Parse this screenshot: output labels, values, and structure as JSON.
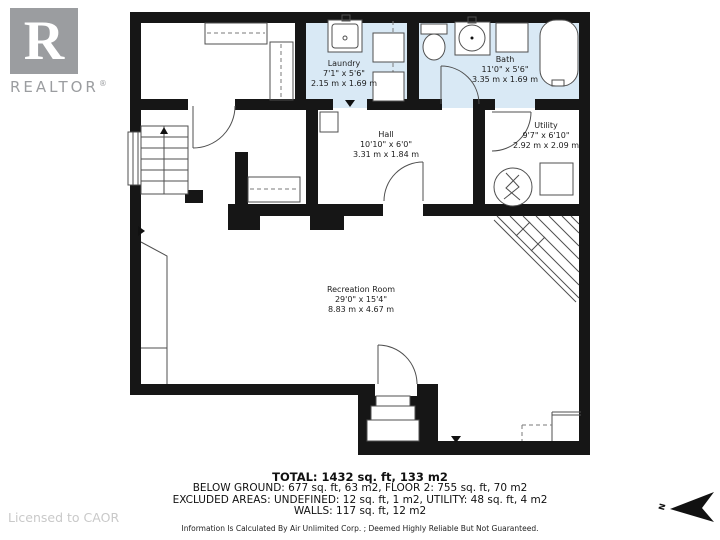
{
  "branding": {
    "logo_letter": "R",
    "logo_word": "REALTOR",
    "registered": "®",
    "license": "Licensed to CAOR"
  },
  "rooms": {
    "laundry": {
      "name": "Laundry",
      "imperial": "7'1\" x 5'6\"",
      "metric": "2.15 m x 1.69 m"
    },
    "bath": {
      "name": "Bath",
      "imperial": "11'0\" x 5'6\"",
      "metric": "3.35 m x 1.69 m"
    },
    "hall": {
      "name": "Hall",
      "imperial": "10'10\" x 6'0\"",
      "metric": "3.31 m x 1.84 m"
    },
    "utility": {
      "name": "Utility",
      "imperial": "9'7\" x 6'10\"",
      "metric": "2.92 m x 2.09 m"
    },
    "recreation": {
      "name": "Recreation Room",
      "imperial": "29'0\" x 15'4\"",
      "metric": "8.83 m x 4.67 m"
    }
  },
  "summary": {
    "total": "TOTAL: 1432 sq. ft, 133 m2",
    "below_ground": "BELOW GROUND: 677 sq. ft, 63 m2, FLOOR 2: 755 sq. ft, 70 m2",
    "excluded": "EXCLUDED AREAS: UNDEFINED: 12 sq. ft, 1 m2, UTILITY: 48 sq. ft, 4 m2",
    "walls": "WALLS: 117 sq. ft, 12 m2",
    "disclaimer": "Information Is Calculated By Air Unlimited Corp. ; Deemed Highly Reliable But Not Guaranteed."
  },
  "compass": {
    "north_label": "N"
  },
  "colors": {
    "wall": "#161616",
    "wet_room_fill": "#d9e9f5",
    "line": "#4f4f4f",
    "logo_gray": "#9b9da0",
    "license_gray": "#c9c9c9"
  }
}
